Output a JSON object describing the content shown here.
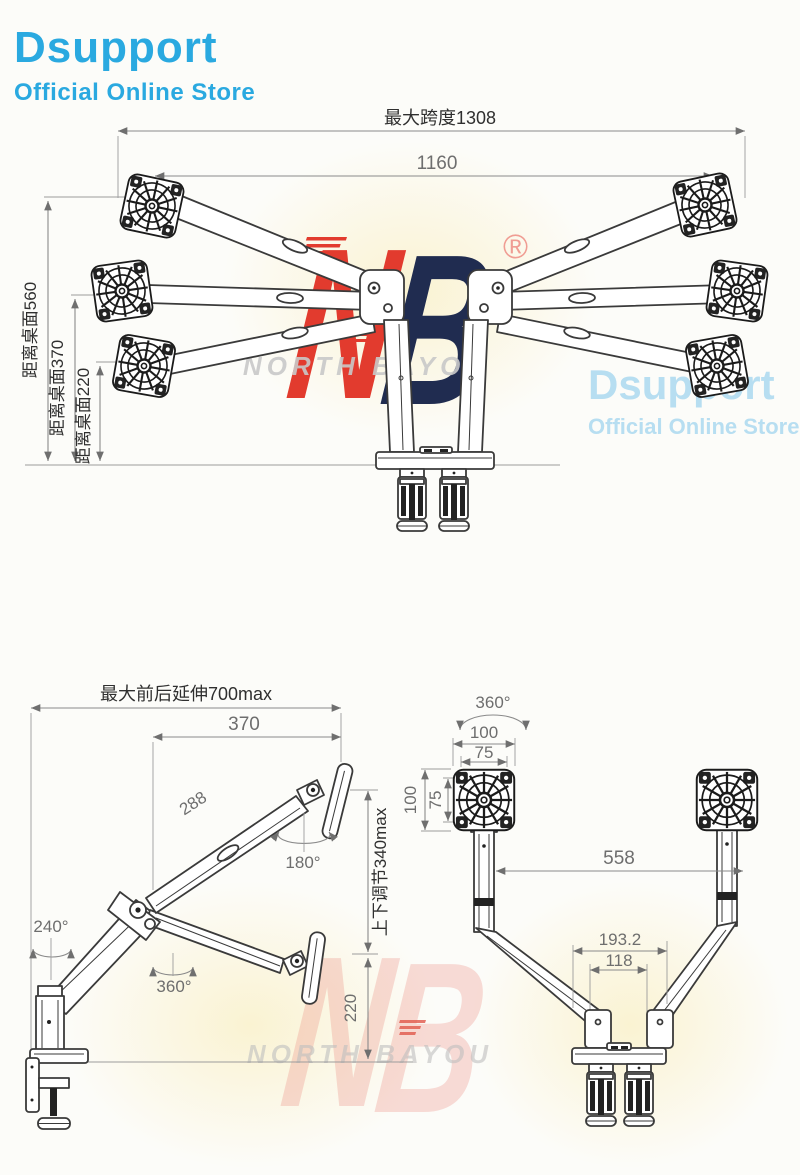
{
  "store_logo": {
    "title": "Dsupport",
    "subtitle": "Official Online Store",
    "color": "#2aa9e0"
  },
  "store_watermark": {
    "title": "Dsupport",
    "subtitle": "Official Online Store"
  },
  "brand_watermark": {
    "n": "N",
    "b": "B",
    "registered": "®",
    "wordmark": "NORTH BAYOU"
  },
  "colors": {
    "logo_blue": "#2aa9e0",
    "nb_red": "#e23b2e",
    "nb_navy": "#202c50",
    "line_art": "#3a3a3a",
    "dimension": "#8a8a8a"
  },
  "front_view": {
    "dim_span_max": "最大跨度1308",
    "dim_span_inner": "1160",
    "dim_desk_560": "距离桌面560",
    "dim_desk_370": "距离桌面370",
    "dim_desk_220": "距离桌面220"
  },
  "side_view": {
    "dim_reach_max": "最大前后延伸700max",
    "dim_370": "370",
    "dim_288": "288",
    "rot_head": "180°",
    "rot_elbow": "240°",
    "rot_base": "360°",
    "dim_lift": "上下调节340max",
    "dim_220": "220"
  },
  "rear_view": {
    "rot_head": "360°",
    "dim_plate_100_h": "100",
    "dim_plate_75_h": "75",
    "dim_plate_100_v": "100",
    "dim_plate_75_v": "75",
    "dim_span_558": "558",
    "dim_base_193": "193.2",
    "dim_base_118": "118"
  }
}
